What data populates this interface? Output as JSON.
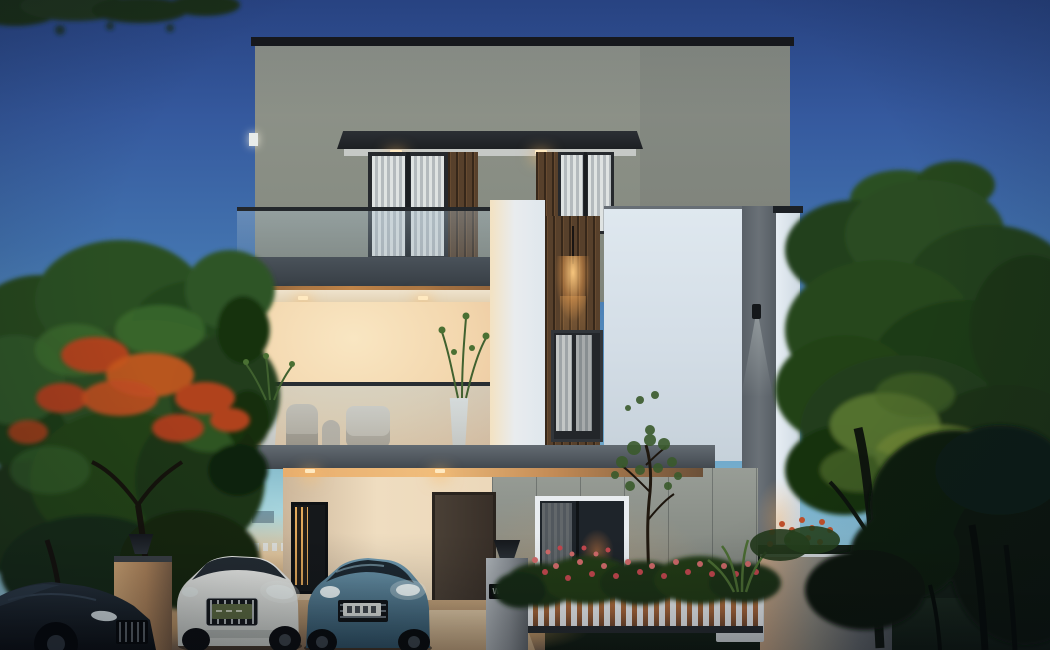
{
  "scene": {
    "type": "exterior architectural rendering",
    "time_of_day": "dusk",
    "description": "Three-storey modern villa with glass-railed balconies and warm interior lighting, flanked by flowering trees, with three cars parked on the driveway"
  },
  "house": {
    "gate_sign": "W-45",
    "storeys": "3"
  },
  "vehicles": {
    "left": "dark sedan, partially cropped",
    "middle": "white car with green license plate (text illegible)",
    "right": "blue sedan with white license plate (text illegible)"
  },
  "palette": {
    "sky_top": "#2c4a8e",
    "sky_horizon": "#a5d4de",
    "facade_grey": "#8f948b",
    "facade_white": "#dfe8ef",
    "slab_concrete": "#4a525a",
    "warm_light": "#f7c87c",
    "terrace_glow": "#f8e2bd",
    "wood_cladding": "#57402b",
    "foliage_green": "#27471f",
    "flower_red": "#b0431d",
    "fence_white": "#eaeef1",
    "driveway": "#c3a37c",
    "car_white": "#f2f3f0",
    "car_blue": "#41708c",
    "car_dark": "#161b20"
  }
}
